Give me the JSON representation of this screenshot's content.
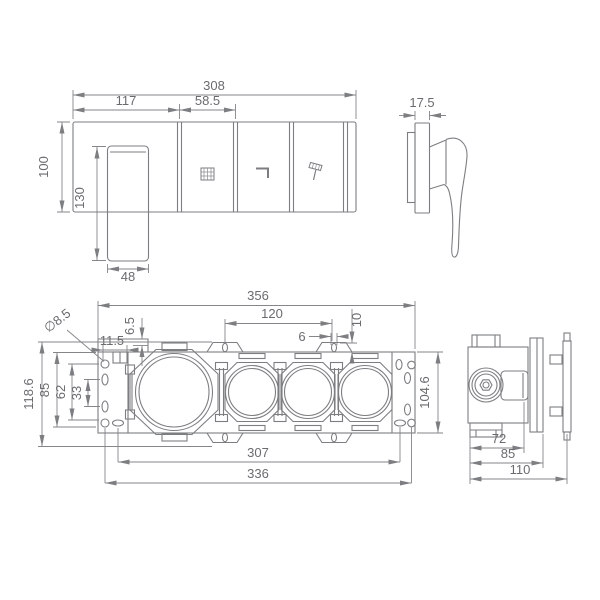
{
  "colors": {
    "line": "#7c7e81",
    "dimension_line": "#84868a",
    "text": "#696b6e",
    "background": "#ffffff"
  },
  "front_view": {
    "dimensions": {
      "overall_width": "308",
      "section_1_width": "117",
      "section_2_width": "58.5",
      "body_height": "100",
      "handle_length": "130",
      "handle_width": "48"
    },
    "buttons": [
      {
        "icon": "rain-shower"
      },
      {
        "icon": "tub-spout"
      },
      {
        "icon": "hand-shower"
      }
    ]
  },
  "mixer_side_view": {
    "dimensions": {
      "plate_depth": "17.5"
    }
  },
  "bracket_front_view": {
    "dimensions": {
      "overall_width": "356",
      "tab_spacing": "120",
      "slot_offset": "6",
      "tab_height": "10",
      "notch_depth": "6.5",
      "hole_offset": "11.5",
      "hole_diameter": "∅8.5",
      "overall_height": "118.6",
      "plate_height": "85",
      "hole_span": "62",
      "oval_span": "33",
      "right_plate_height": "104.6",
      "mount_hole_span": "307",
      "outer_hole_span": "336"
    }
  },
  "bracket_side_view": {
    "dimensions": {
      "body_depth": "72",
      "flange_depth": "85",
      "overall_depth": "110"
    }
  }
}
